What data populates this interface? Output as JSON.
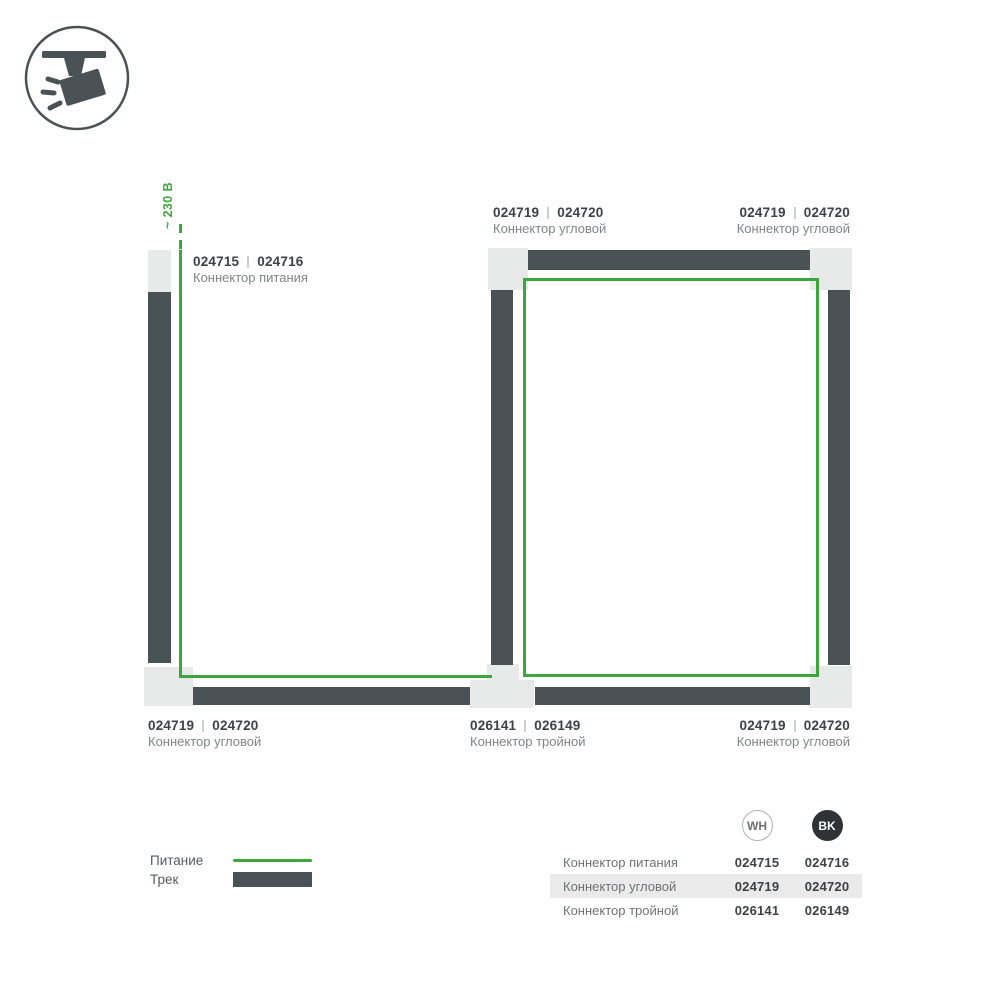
{
  "diagram": {
    "voltage_label": "~ 230 В",
    "divider": "|"
  },
  "callouts": [
    {
      "id": "power-connector",
      "wh": "024715",
      "bk": "024716",
      "name": "Коннектор питания"
    },
    {
      "id": "corner-top-mid",
      "wh": "024719",
      "bk": "024720",
      "name": "Коннектор угловой"
    },
    {
      "id": "corner-top-right",
      "wh": "024719",
      "bk": "024720",
      "name": "Коннектор угловой"
    },
    {
      "id": "corner-bottom-left",
      "wh": "024719",
      "bk": "024720",
      "name": "Коннектор угловой"
    },
    {
      "id": "triple-bottom-mid",
      "wh": "026141",
      "bk": "026149",
      "name": "Коннектор тройной"
    },
    {
      "id": "corner-bottom-right",
      "wh": "024719",
      "bk": "024720",
      "name": "Коннектор угловой"
    }
  ],
  "legend": {
    "power_label": "Питание",
    "track_label": "Трек"
  },
  "table": {
    "columns": {
      "wh": "WH",
      "bk": "BK"
    },
    "rows": [
      {
        "name": "Коннектор питания",
        "wh": "024715",
        "bk": "024716"
      },
      {
        "name": "Коннектор угловой",
        "wh": "024719",
        "bk": "024720"
      },
      {
        "name": "Коннектор тройной",
        "wh": "026141",
        "bk": "026149"
      }
    ]
  },
  "colors": {
    "power_line_green": "#3aa83c",
    "track_dark": "#4b5255",
    "connector_gray": "#e8eaea",
    "bk_badge": "#2f3335"
  }
}
